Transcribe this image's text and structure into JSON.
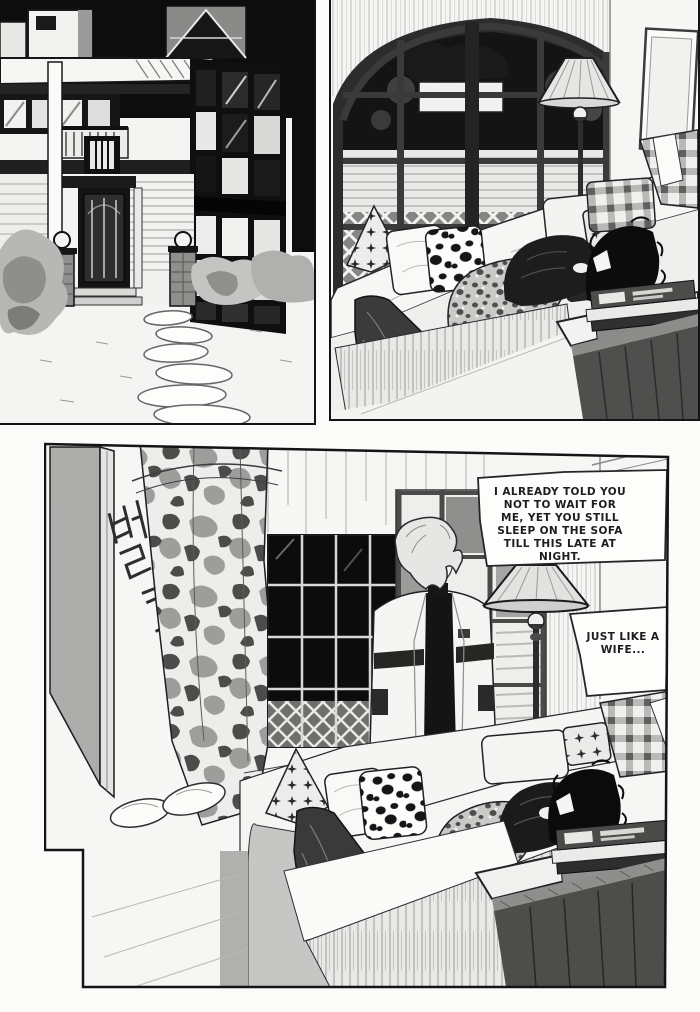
{
  "page": {
    "kind_label": "manga page",
    "colors": {
      "paper": "#f6f6f4",
      "ink": "#1a1a1a",
      "night_sky": "#0d0d0d",
      "door_gray": "#adadab"
    }
  },
  "panels": [
    {
      "name": "house-exterior-night"
    },
    {
      "name": "living-room-sleeping-on-sofa"
    },
    {
      "name": "door-opens-man-enters"
    }
  ],
  "dialogue": {
    "bubble_1": "I ALREADY TOLD YOU NOT TO WAIT FOR ME, YET YOU STILL SLEEP ON THE SOFA TILL THIS LATE AT NIGHT.",
    "bubble_2": "JUST LIKE A WIFE..."
  },
  "sfx": {
    "door_open_korean": "벌컥"
  }
}
